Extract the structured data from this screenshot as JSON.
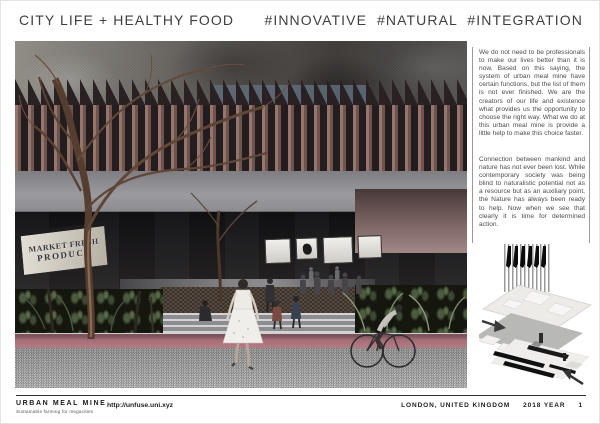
{
  "header": {
    "title_left": "CITY LIFE + HEALTHY FOOD",
    "title_right": "#INNOVATIVE  #NATURAL  #INTEGRATION"
  },
  "render": {
    "sign_line1": "MARKET FRESH",
    "sign_line2": "PRODUCE"
  },
  "sidebar": {
    "paragraph1": "We do not need to be professionals to make our lives better than it is now. Based on this saying, the system of urban meal mine have certain functions, but the list of them is not ever finished. We are the creators of our life and existence what provides us the opportunity to choose the right way. What we do at this urban meal mine is provide a little help to make this choice faster.",
    "paragraph2": "Connection between mankind and nature has not ever been lost. While contemporary society was being blind to naturalistic potential not as a resource but as an auxiliary point, the Nature has always been ready to help. Now when we see that clearly it is time for determined action."
  },
  "footer": {
    "brand": "URBAN MEAL MINE",
    "tagline": "Sustainable farming for megacities",
    "url": "http://unfuse.uni.xyz",
    "location": "LONDON, UNITED KINGDOM",
    "year": "2018 YEAR",
    "page_number": "1"
  },
  "colors": {
    "lane_stripe": "#a86e78",
    "fin_brown": "#8a6c63",
    "ink": "#3d3d3d"
  }
}
